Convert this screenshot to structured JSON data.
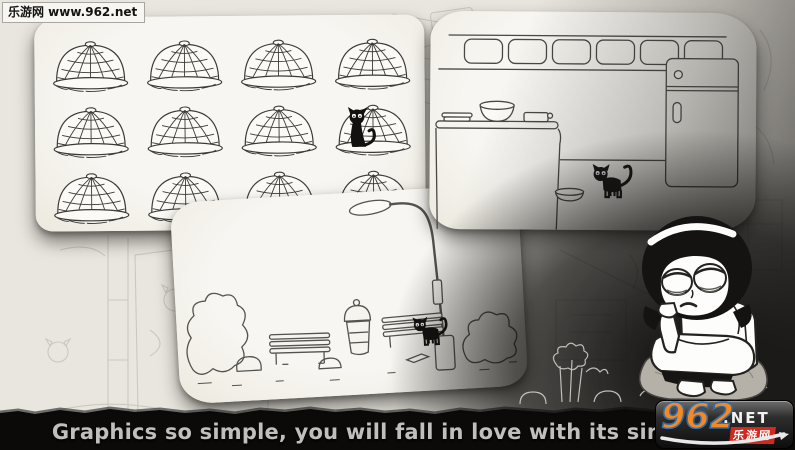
{
  "watermark": {
    "text": "乐游网 www.962.net"
  },
  "caption": {
    "text": "Graphics so simple, you will fall in love with its simplicity"
  },
  "logo": {
    "number": "962",
    "suffix": ".NET",
    "site_name": "乐游网"
  },
  "colors": {
    "background_paper": "#e9e6df",
    "panel_paper": "#f5f3ee",
    "sketch_ink": "#4a4845",
    "band_black": "#0b0a09",
    "caption_gray": "#c2bebb",
    "logo_orange": "#f6881f",
    "logo_blue": "#2f6fae",
    "logo_red": "#ce2a20",
    "rock_gray": "#b5b1a8"
  },
  "illustrations": {
    "panel_cages": "grid-of-wire-cages-with-black-cat",
    "panel_kitchen": "kitchen-fridge-counter-with-black-cat",
    "panel_street": "street-lamp-benches-with-black-cat",
    "character": "sad-girl-sitting-on-rock"
  }
}
